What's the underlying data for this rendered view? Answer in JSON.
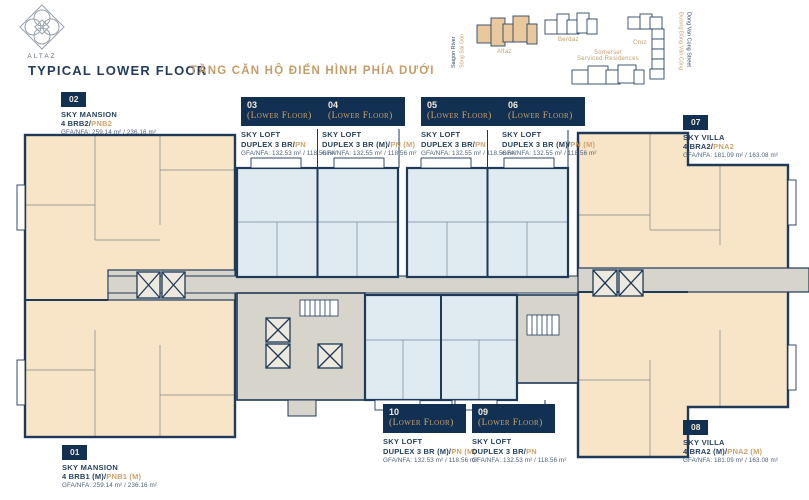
{
  "header": {
    "brand": "ALTAZ",
    "title": "TYPICAL LOWER FLOOR",
    "title_vi": "TẦNG CĂN HỘ ĐIỂN HÌNH PHÍA DƯỚI"
  },
  "site_map": {
    "altaz": "Altaz",
    "berdaz": "Berdaz",
    "cruz": "Cruz",
    "serviced_line1": "Somerset",
    "serviced_line2": "Serviced Residences",
    "river_en": "Saigon River",
    "river_vi": "Sông Sài Gòn",
    "street_en": "Dong Van Cong Street",
    "street_vi": "Đường Đồng Văn Cống"
  },
  "units": {
    "u01": {
      "no": "01",
      "name": "SKY MANSION",
      "type_dark": "4 BRB1 (M)/",
      "type_gold": "PNB1 (M)",
      "area": "GFA/NFA: 259.14 m² / 236.16 m²"
    },
    "u02": {
      "no": "02",
      "name": "SKY MANSION",
      "type_dark": "4 BRB2/",
      "type_gold": "PNB2",
      "area": "GFA/NFA: 259.14 m² / 236.16 m²"
    },
    "u03": {
      "no": "03",
      "floor": "(Lower Floor)",
      "name": "SKY LOFT",
      "type_dark": "DUPLEX 3 BR/",
      "type_gold": "PN",
      "area": "GFA/NFA: 132.53 m² / 118.56 m²"
    },
    "u04": {
      "no": "04",
      "floor": "(Lower Floor)",
      "name": "SKY LOFT",
      "type_dark": "DUPLEX 3 BR (M)/",
      "type_gold": "PN (M)",
      "area": "GFA/NFA: 132.55 m² / 118.56 m²"
    },
    "u05": {
      "no": "05",
      "floor": "(Lower Floor)",
      "name": "SKY LOFT",
      "type_dark": "DUPLEX 3 BR/",
      "type_gold": "PN",
      "area": "GFA/NFA: 132.55 m² / 118.56 m²"
    },
    "u06": {
      "no": "06",
      "floor": "(Lower Floor)",
      "name": "SKY LOFT",
      "type_dark": "DUPLEX 3 BR (M)/",
      "type_gold": "PN (M)",
      "area": "GFA/NFA: 132.55 m² / 118.56 m²"
    },
    "u07": {
      "no": "07",
      "name": "SKY VILLA",
      "type_dark": "4 BRA2/",
      "type_gold": "PNA2",
      "area": "GFA/NFA: 181.09 m² / 163.08 m²"
    },
    "u08": {
      "no": "08",
      "name": "SKY VILLA",
      "type_dark": "4 BRA2 (M)/",
      "type_gold": "PNA2 (M)",
      "area": "GFA/NFA: 181.09 m² / 163.08 m²"
    },
    "u09": {
      "no": "09",
      "floor": "(Lower Floor)",
      "name": "SKY LOFT",
      "type_dark": "DUPLEX 3 BR/",
      "type_gold": "PN",
      "area": "GFA/NFA: 132.53 m² / 118.56 m²"
    },
    "u10": {
      "no": "10",
      "floor": "(Lower Floor)",
      "name": "SKY LOFT",
      "type_dark": "DUPLEX 3 BR (M)/",
      "type_gold": "PN (M)",
      "area": "GFA/NFA: 132.53 m² / 118.56 m²"
    }
  },
  "colors": {
    "navy": "#1e3a58",
    "gold": "#c59c68",
    "tan": "#f8e4c6",
    "blue": "#dfeaf1",
    "gray": "#d7d4cc",
    "badge": "#123051"
  }
}
